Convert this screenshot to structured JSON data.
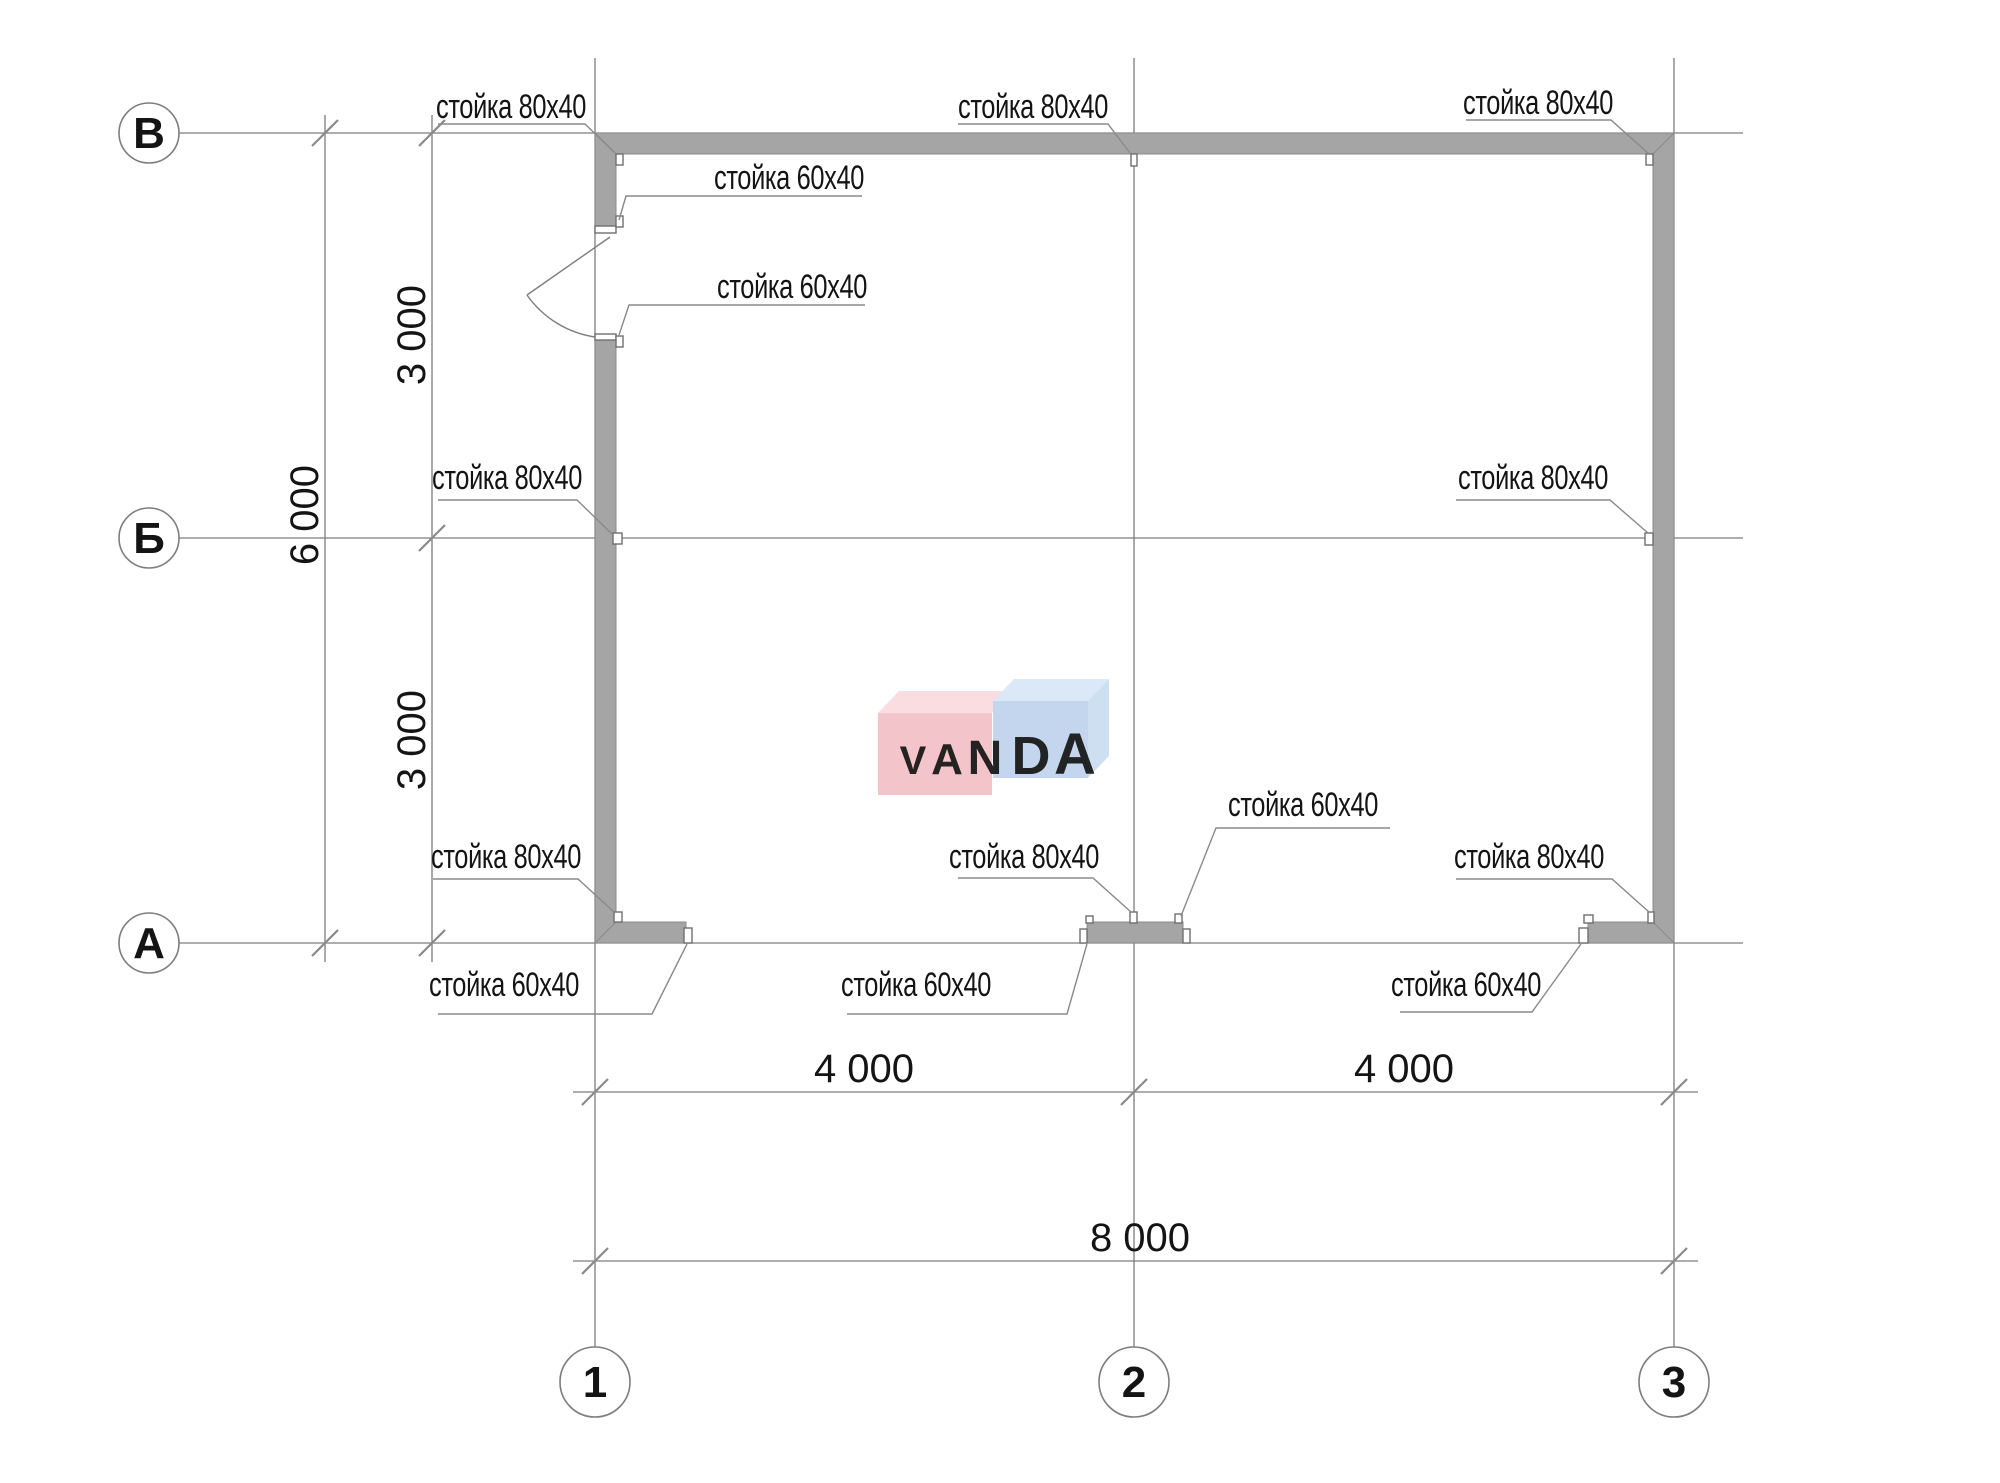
{
  "grid": {
    "rows": [
      {
        "label": "В"
      },
      {
        "label": "Б"
      },
      {
        "label": "А"
      }
    ],
    "cols": [
      {
        "label": "1"
      },
      {
        "label": "2"
      },
      {
        "label": "3"
      }
    ]
  },
  "dimensions": {
    "row_spans": [
      "3 000",
      "3 000"
    ],
    "row_total": "6 000",
    "col_spans": [
      "4 000",
      "4 000"
    ],
    "col_total": "8 000"
  },
  "callouts": [
    {
      "id": "post-80x40-top-left",
      "text": "стойка 80x40"
    },
    {
      "id": "post-80x40-top-center",
      "text": "стойка 80x40"
    },
    {
      "id": "post-80x40-top-right",
      "text": "стойка 80x40"
    },
    {
      "id": "post-60x40-door-top",
      "text": "стойка 60x40"
    },
    {
      "id": "post-60x40-door-bottom",
      "text": "стойка 60x40"
    },
    {
      "id": "post-80x40-mid-left",
      "text": "стойка 80x40"
    },
    {
      "id": "post-80x40-mid-right",
      "text": "стойка 80x40"
    },
    {
      "id": "post-80x40-bottom-left",
      "text": "стойка 80x40"
    },
    {
      "id": "post-80x40-bottom-center",
      "text": "стойка 80x40"
    },
    {
      "id": "post-80x40-bottom-right",
      "text": "стойка 80x40"
    },
    {
      "id": "post-60x40-below-left",
      "text": "стойка 60x40"
    },
    {
      "id": "post-60x40-below-center",
      "text": "стойка 60x40"
    },
    {
      "id": "post-60x40-above-center",
      "text": "стойка 60x40"
    },
    {
      "id": "post-60x40-below-right",
      "text": "стойка 60x40"
    }
  ],
  "watermark": {
    "text": "VANDA",
    "letters": [
      "V",
      "A",
      "N",
      "D",
      "A"
    ],
    "front_left_color": "#f3c4ca",
    "top_left_color": "#f9dde1",
    "front_right_color": "#c3d6ee",
    "top_right_color": "#dbe8f7",
    "side_right_color": "#cfdff2",
    "letter_color": "#ffffff"
  },
  "colors": {
    "wall_fill": "#a5a5a5",
    "line": "#7d7d7d",
    "text": "#141414"
  }
}
